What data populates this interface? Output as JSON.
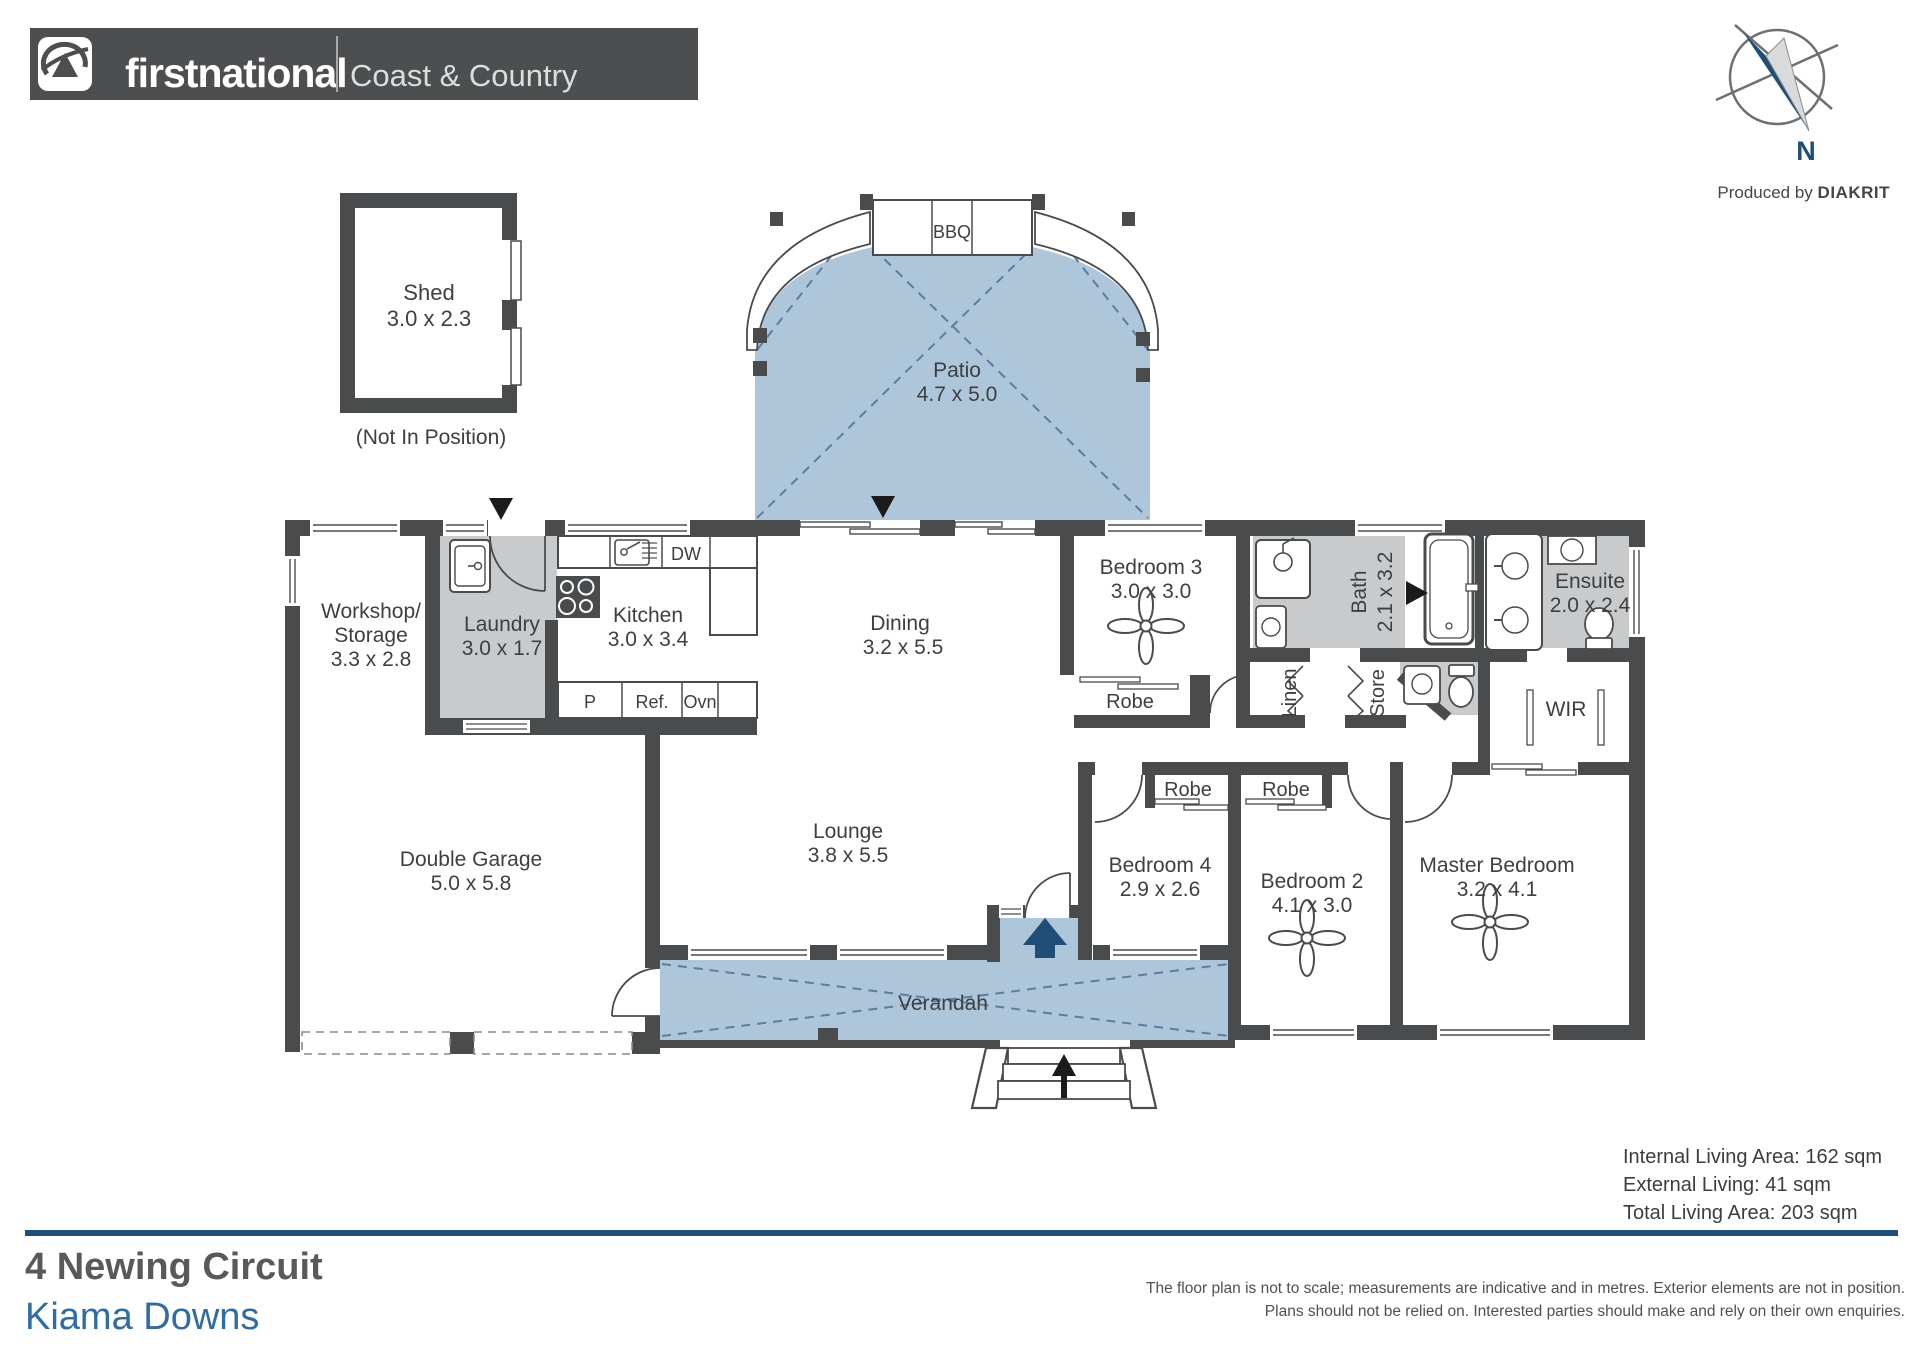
{
  "header": {
    "brand_bold": "firstnational",
    "brand_sub": "REAL ESTATE",
    "office": "Coast & Country"
  },
  "compass": {
    "north": "N"
  },
  "credit": {
    "prefix": "Produced by ",
    "brand": "DIAKRIT"
  },
  "plan": {
    "shed": {
      "name": "Shed",
      "dims": "3.0 x 2.3"
    },
    "shed_note": "(Not In Position)",
    "bbq": "BBQ",
    "patio": {
      "name": "Patio",
      "dims": "4.7 x 5.0"
    },
    "workshop": {
      "name1": "Workshop/",
      "name2": "Storage",
      "dims": "3.3 x 2.8"
    },
    "laundry": {
      "name": "Laundry",
      "dims": "3.0 x 1.7"
    },
    "kitchen": {
      "name": "Kitchen",
      "dims": "3.0 x 3.4"
    },
    "dining": {
      "name": "Dining",
      "dims": "3.2 x 5.5"
    },
    "bedroom3": {
      "name": "Bedroom 3",
      "dims": "3.0 x 3.0"
    },
    "bath": {
      "name": "Bath",
      "dims": "2.1 x 3.2"
    },
    "ensuite": {
      "name": "Ensuite",
      "dims": "2.0 x 2.4"
    },
    "wir": "WIR",
    "linen": "Linen",
    "store": "Store",
    "robe": "Robe",
    "garage": {
      "name": "Double Garage",
      "dims": "5.0 x 5.8"
    },
    "lounge": {
      "name": "Lounge",
      "dims": "3.8 x 5.5"
    },
    "verandah": "Verandah",
    "bedroom4": {
      "name": "Bedroom 4",
      "dims": "2.9 x 2.6"
    },
    "bedroom2": {
      "name": "Bedroom 2",
      "dims": "4.1 x 3.0"
    },
    "master": {
      "name": "Master Bedroom",
      "dims": "3.2 x 4.1"
    },
    "fixtures": {
      "dw": "DW",
      "pantry": "P",
      "fridge": "Ref.",
      "oven": "Ovn"
    }
  },
  "areas": {
    "internal": "Internal Living Area: 162 sqm",
    "external": "External Living: 41 sqm",
    "total": "Total Living Area: 203 sqm"
  },
  "address": {
    "street": "4 Newing Circuit",
    "suburb": "Kiama Downs"
  },
  "disclaimer": {
    "line1": "The floor plan is not to scale; measurements are indicative and in metres. Exterior elements are not in position.",
    "line2": "Plans should not be relied on. Interested parties should make and rely on their own enquiries."
  },
  "colors": {
    "wall": "#4a4b4d",
    "patio_fill": "#adc6da",
    "floor_gray": "#c9cacc",
    "accent_navy": "#1f4e79",
    "address_blue": "#2d6ca6"
  }
}
